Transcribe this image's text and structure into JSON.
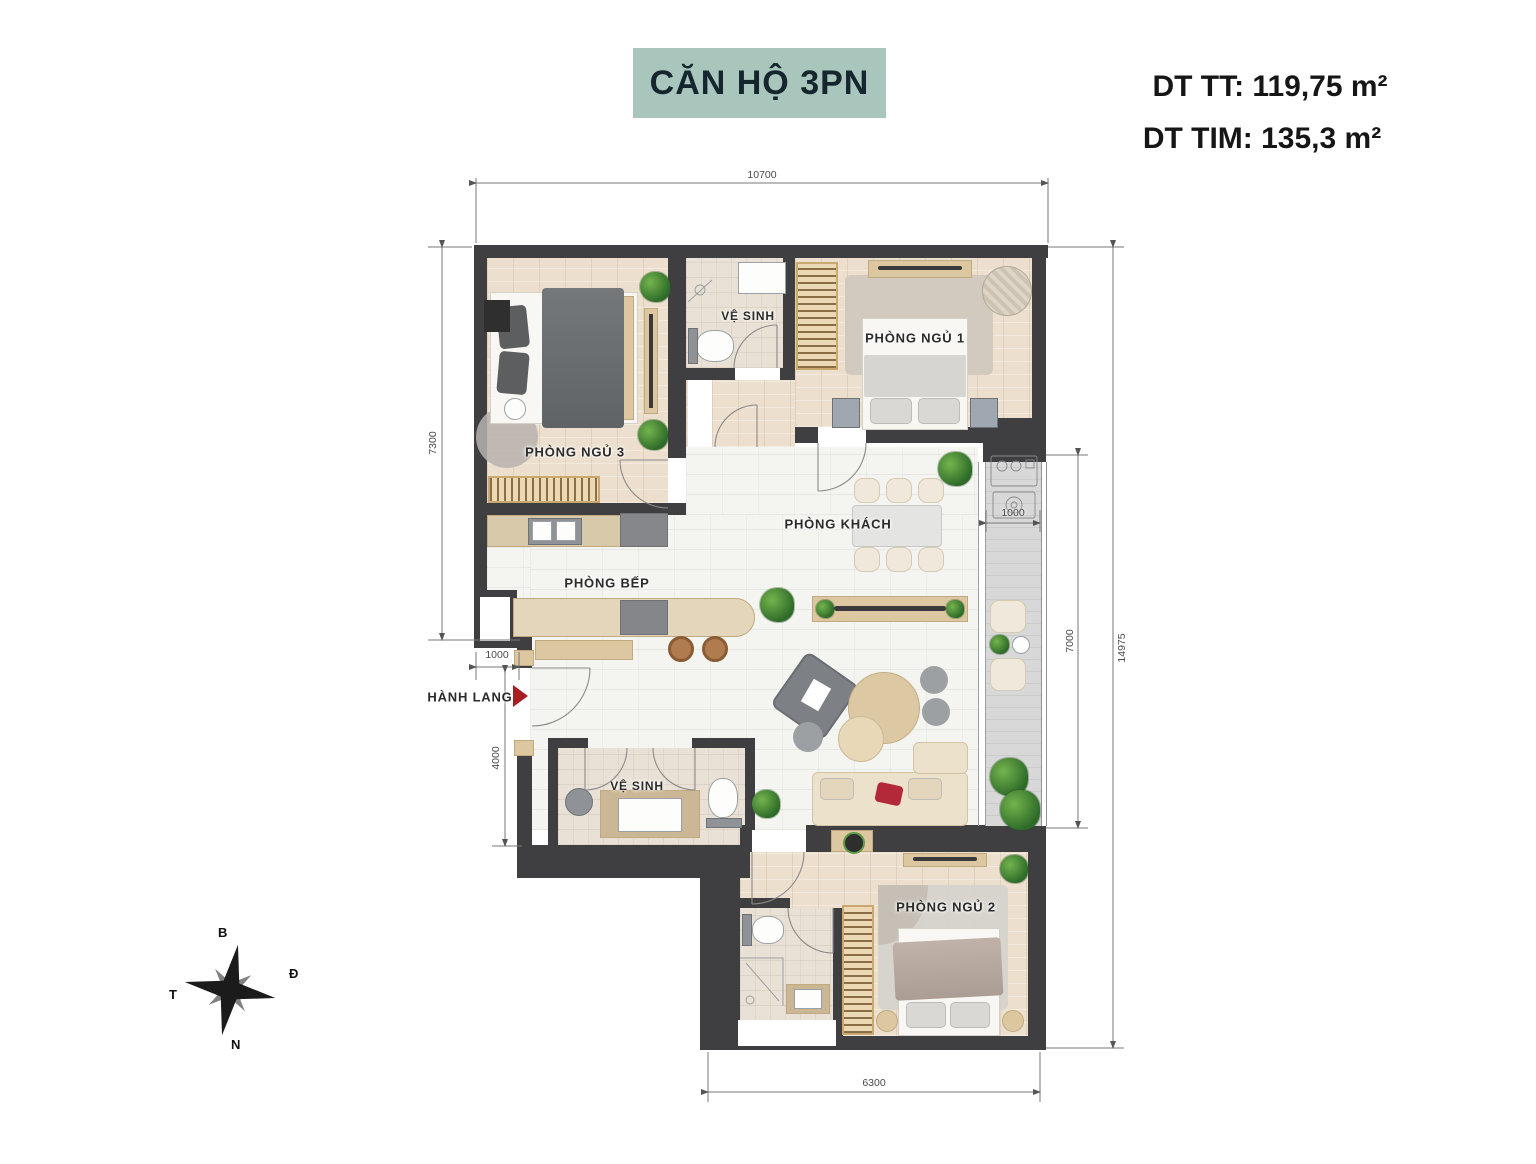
{
  "header": {
    "title": "CĂN HỘ 3PN",
    "area_tt": "DT TT: 119,75 m²",
    "area_tim": "DT TIM: 135,3 m²"
  },
  "rooms": {
    "bedroom3": "PHÒNG NGỦ 3",
    "bedroom1": "PHÒNG NGỦ 1",
    "bedroom2": "PHÒNG NGỦ 2",
    "bath1": "VỆ SINH",
    "bath2": "VỆ SINH",
    "living": "PHÒNG KHÁCH",
    "kitchen": "PHÒNG BẾP",
    "hallway": "HÀNH LANG"
  },
  "dims": {
    "top": "10700",
    "left_upper": "7300",
    "entry_width": "1000",
    "left_lower": "4000",
    "right_total": "14975",
    "balcony_height": "7000",
    "balcony_width": "1000",
    "bottom": "6300"
  },
  "compass": {
    "north": "B",
    "east": "Đ",
    "west": "T",
    "south": "N"
  },
  "colors": {
    "title_bg": "#a9c6bd",
    "wall": "#3f3f42",
    "entry_arrow": "#a81e22",
    "wood_floor": "#ecdfcd",
    "marble_floor": "#f4f4f1",
    "balcony_floor": "#d7d8d7"
  }
}
